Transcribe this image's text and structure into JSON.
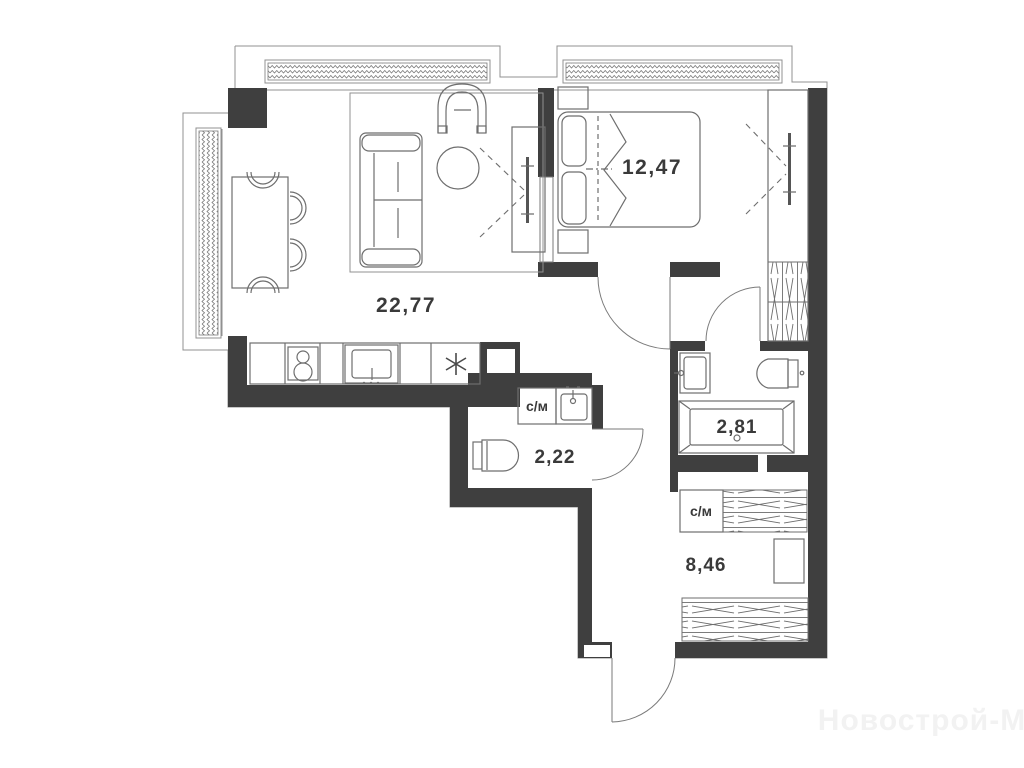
{
  "plan": {
    "rooms": [
      {
        "name": "living-room-kitchen",
        "area_label": "22,77"
      },
      {
        "name": "bedroom",
        "area_label": "12,47"
      },
      {
        "name": "bathroom",
        "area_label": "2,81"
      },
      {
        "name": "wc",
        "area_label": "2,22"
      },
      {
        "name": "hallway",
        "area_label": "8,46"
      }
    ],
    "appliance_labels": {
      "wc_washing_machine": "с/м",
      "hall_washing_machine": "с/м"
    },
    "watermark": "Новострой-М",
    "colors": {
      "wall": "#3f3f3f",
      "line": "#6e6e6e",
      "outline": "#909090",
      "label": "#3a3a3a",
      "watermark": "#f2f2f2",
      "bg": "#ffffff"
    }
  }
}
